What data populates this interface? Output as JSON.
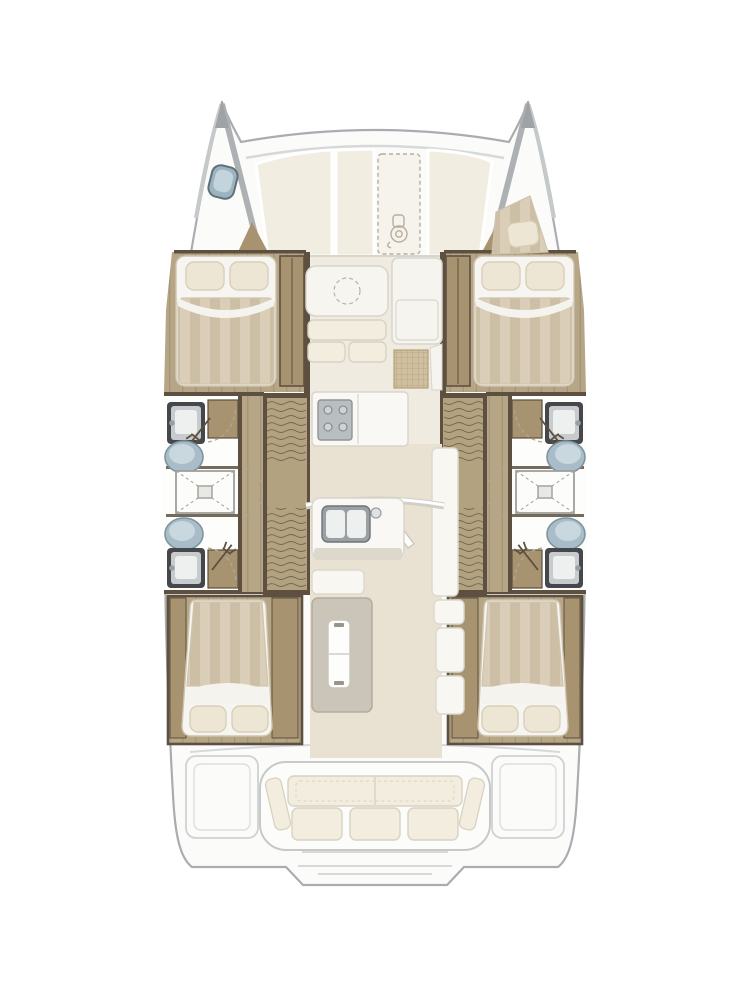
{
  "diagram": {
    "title": "Catamaran interior floor plan",
    "view": "top-down, bow up",
    "vessel_type": "sailing catamaran",
    "hulls": 2,
    "cabins": 4,
    "heads": 4,
    "shower_rooms": 2
  },
  "foredeck": {
    "port_bow_features": [
      "deck-hatch"
    ],
    "starboard_bow_features": [
      "crew-berth-cushion",
      "pillow"
    ],
    "center_features": [
      "deck-panels",
      "anchor-windlass-locker"
    ],
    "windlass_icon": "anchor-windlass"
  },
  "salon": {
    "forward_furniture": [
      "table-with-dashed-circle",
      "two-seat-sofa",
      "side-console",
      "woven-grid-mat"
    ],
    "galley_furniture": [
      "four-burner-stove",
      "worktop",
      "double-sink",
      "faucet",
      "open-sliding-door"
    ],
    "aft_furniture": [
      "island-with-cooler",
      "storage-cabinets",
      "tall-locker"
    ]
  },
  "hull_port": {
    "forward_cabin": {
      "bed": "double",
      "pillow_count": 2,
      "wardrobe_count": 1
    },
    "forward_head": [
      "vanity-sink",
      "marine-toilet",
      "hand-shower"
    ],
    "shower_room": [
      "shower-tray",
      "drain",
      "folding-doors"
    ],
    "aft_head": [
      "marine-toilet",
      "vanity-sink",
      "hand-shower"
    ],
    "companionway": {
      "stair_flights": 2,
      "landing": 1
    },
    "aft_cabin": {
      "bed": "double",
      "pillow_count": 2,
      "wardrobe_count": 2
    }
  },
  "hull_starboard": {
    "mirror_of": "hull_port"
  },
  "cockpit": {
    "bench": {
      "back_cushions": 2,
      "seat_cushions": 3,
      "side_bolsters": 2
    },
    "side_lockers": 2,
    "stern_features": [
      "swim-steps",
      "central-platform"
    ]
  },
  "colors": {
    "hull-fill": "#fbfbfa",
    "hull-stroke": "#a9adaf",
    "deck-line": "#d6d9d8",
    "bow-band": "#aeb1b3",
    "panel": "#f1ede1",
    "windlass-dash": "#b7ae9c",
    "wood-floor": "#b6a686",
    "wood-grain": "#a5967b",
    "wood-trim": "#a7936f",
    "wood-dark": "#5d5040",
    "stair-wood": "#b3a27f",
    "bed-light": "#daceb9",
    "bed-dark": "#ccbfa6",
    "bed-sheet": "#f4f3ee",
    "bed-base": "#f6f5f1",
    "bed-edge": "#cfc4ae",
    "pillow": "#eee6d4",
    "pillow-edge": "#d8cfb9",
    "toilet-body": "#a9bdc9",
    "toilet-inner": "#c9d7de",
    "toilet-rim": "#7e939e",
    "sink-frame": "#45474a",
    "sink-body": "#c7cbcd",
    "basin": "#eef0f0",
    "fixture-line": "#9e9e9a",
    "bath-floor": "#fdfdfc",
    "salon-floor": "#f0ebe0",
    "aisle-floor": "#e9e2d2",
    "counter": "#f9f8f4",
    "counter-edge": "#d8d5cc",
    "stove": "#b9bec1",
    "stove-edge": "#8f9497",
    "island": "#cbc5b9",
    "island-edge": "#b2ac9f",
    "cabinet": "#f8f7f2",
    "cabinet-edge": "#dbd8cf",
    "cushion": "#f2edde",
    "cushion-edge": "#d8d2c1",
    "grid-mat": "#cfbf9f",
    "grid-line": "#b2a17e",
    "hatch-glass": "#9db4c0",
    "hatch-inner": "#c3d4dc",
    "hatch-rim": "#5f7079",
    "door-dash": "#b0a894"
  }
}
